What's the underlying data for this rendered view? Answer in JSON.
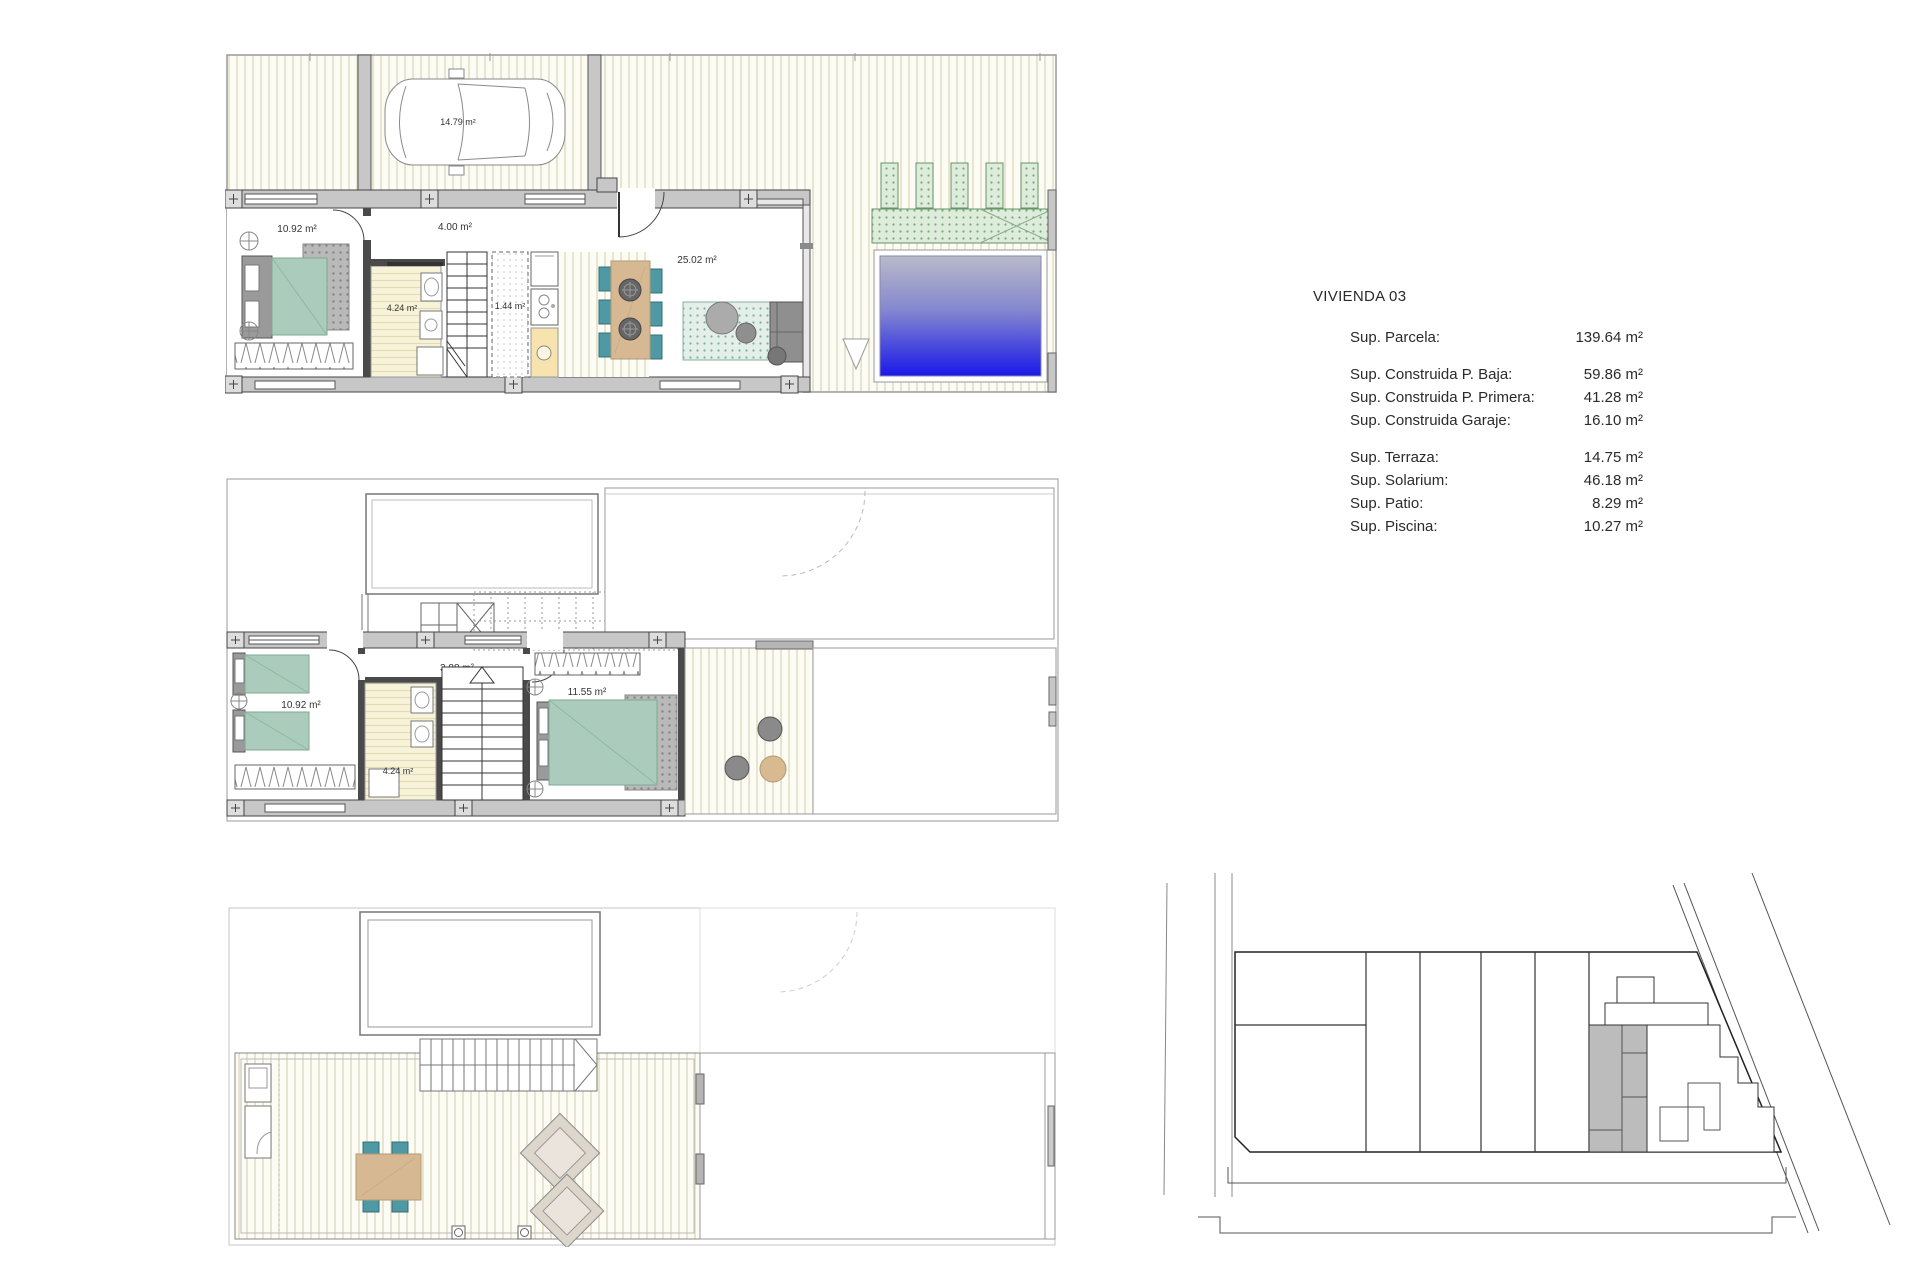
{
  "info_panel": {
    "title": "VIVIENDA 03",
    "rows": [
      {
        "label": "Sup. Parcela:",
        "value": "139.64 m²"
      },
      {
        "label": "Sup. Construida P. Baja:",
        "value": "59.86 m²"
      },
      {
        "label": "Sup. Construida P. Primera:",
        "value": "41.28 m²"
      },
      {
        "label": "Sup. Construida Garaje:",
        "value": "16.10 m²"
      },
      {
        "label": "Sup. Terraza:",
        "value": "14.75 m²"
      },
      {
        "label": "Sup. Solarium:",
        "value": "46.18 m²"
      },
      {
        "label": "Sup. Patio:",
        "value": "8.29 m²"
      },
      {
        "label": "Sup. Piscina:",
        "value": "10.27 m²"
      }
    ]
  },
  "floor_plans": {
    "ground_floor": {
      "room_labels": {
        "garage": "14.79 m²",
        "bedroom": "10.92 m²",
        "hallway": "4.00 m²",
        "bathroom": "4.24 m²",
        "pantry": "1.44 m²",
        "living_kitchen": "25.02 m²"
      }
    },
    "first_floor": {
      "room_labels": {
        "bedroom_left": "10.92 m²",
        "hallway": "3.88 m²",
        "bathroom": "4.24 m²",
        "bedroom_right": "11.55 m²"
      }
    },
    "solarium": {
      "room_labels": {}
    }
  },
  "colors": {
    "pool_top": "#b9bac8",
    "pool_bottom": "#1a18e8",
    "bed_green": "#abccbc",
    "chair_teal": "#4f99a5",
    "table_tan": "#d6b893",
    "wall_gray": "#c7c7c7",
    "pergola_green": "#ddecdb",
    "site_highlight": "#bcbcbc"
  }
}
